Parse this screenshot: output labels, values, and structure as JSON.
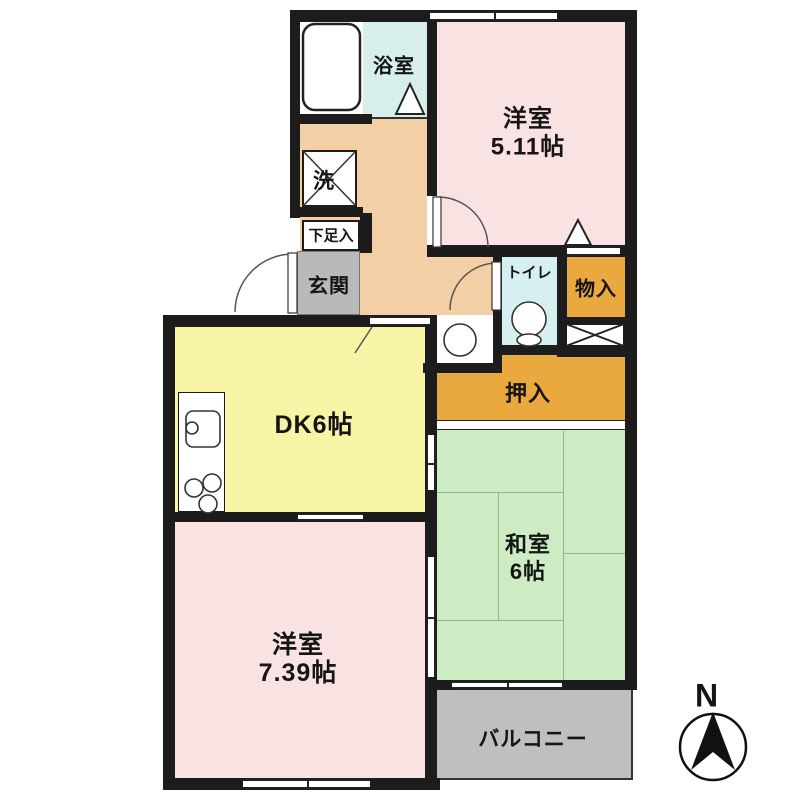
{
  "floorplan": {
    "rooms": {
      "bath": {
        "label": "浴室"
      },
      "washer": {
        "label": "洗"
      },
      "shoe_box": {
        "label": "下足入"
      },
      "entrance": {
        "label": "玄関"
      },
      "western_room_1": {
        "label": "洋室",
        "area": "5.11帖"
      },
      "toilet": {
        "label": "トイレ"
      },
      "storage": {
        "label": "物入"
      },
      "closet": {
        "label": "押入"
      },
      "dining_kitchen": {
        "label": "DK6帖"
      },
      "japanese_room": {
        "label": "和室",
        "area": "6帖"
      },
      "western_room_2": {
        "label": "洋室",
        "area": "7.39帖"
      },
      "balcony": {
        "label": "バルコニー"
      }
    },
    "compass": {
      "label": "N"
    },
    "colors": {
      "wall": "#1c1c1c",
      "western_room": "#f8e3e2",
      "bath": "#d6efec",
      "toilet": "#d6f0f2",
      "hallway": "#f3cfa5",
      "entrance_floor": "#b9b9b9",
      "dining_kitchen": "#f8f4a6",
      "japanese_room": "#cdecc3",
      "closet": "#e9a93e",
      "balcony": "#bfbfbf"
    }
  }
}
